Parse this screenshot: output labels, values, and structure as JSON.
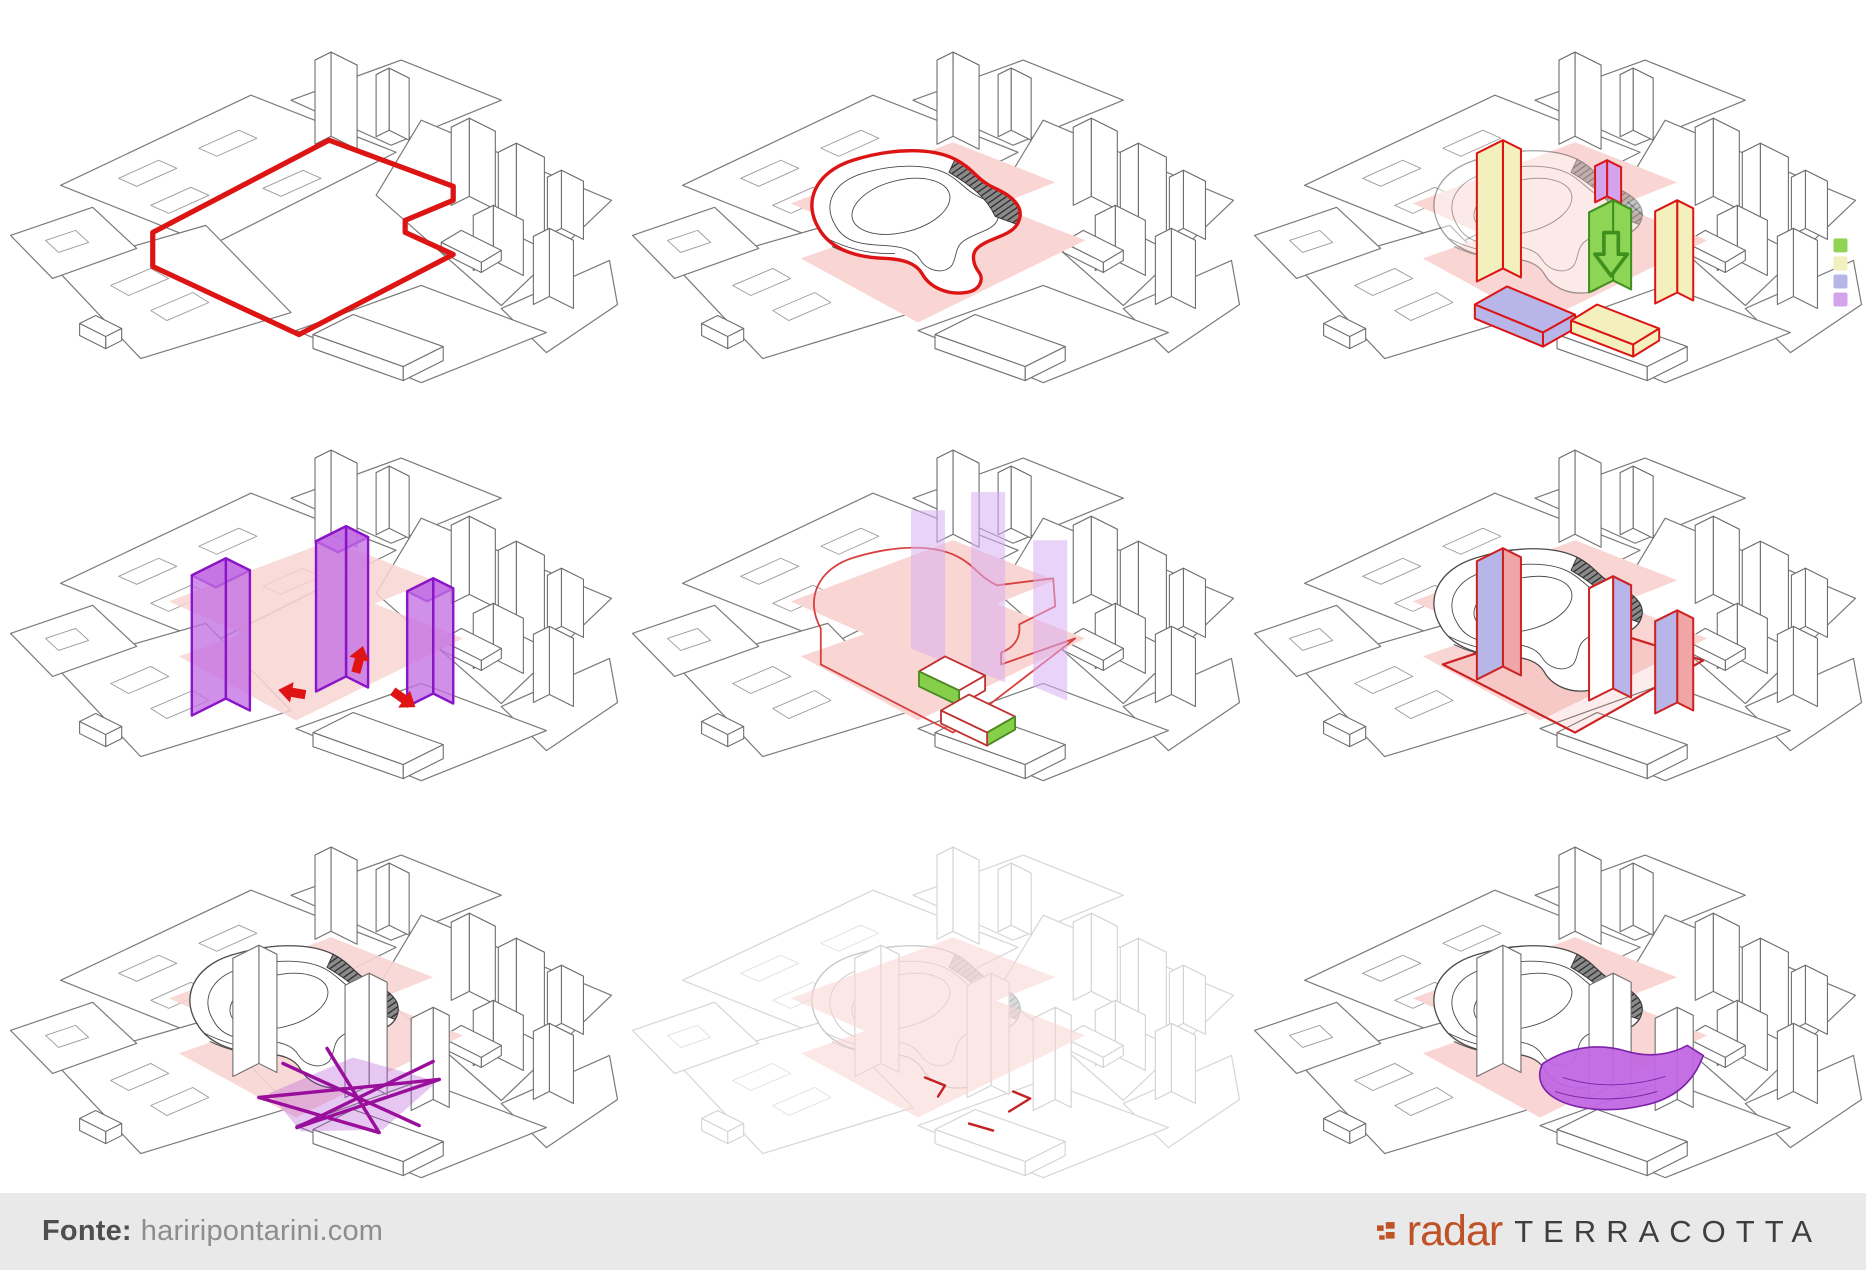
{
  "footer": {
    "source_label": "Fonte:",
    "source_value": "hariripontarini.com",
    "brand": {
      "radar": "radar",
      "terracotta": "TERRACOTTA"
    }
  },
  "legend": {
    "swatches": [
      {
        "name": "green",
        "color": "#8ed455"
      },
      {
        "name": "pale-yellow",
        "color": "#f3f0be"
      },
      {
        "name": "periwinkle",
        "color": "#b8b5e9"
      },
      {
        "name": "lilac",
        "color": "#d4a3ee"
      }
    ]
  },
  "colors": {
    "site_pink": "#f9d5d3",
    "boundary_red": "#dd1414",
    "purple_mass": "#c36fe3",
    "purple_structure": "#990f9b",
    "podium_purple": "#c167e2",
    "green_accent": "#86cf4a",
    "wireframe_gray": "#6f6f6f",
    "terracotta": "#bf5227",
    "footer_bg": "#e9e9e9"
  }
}
